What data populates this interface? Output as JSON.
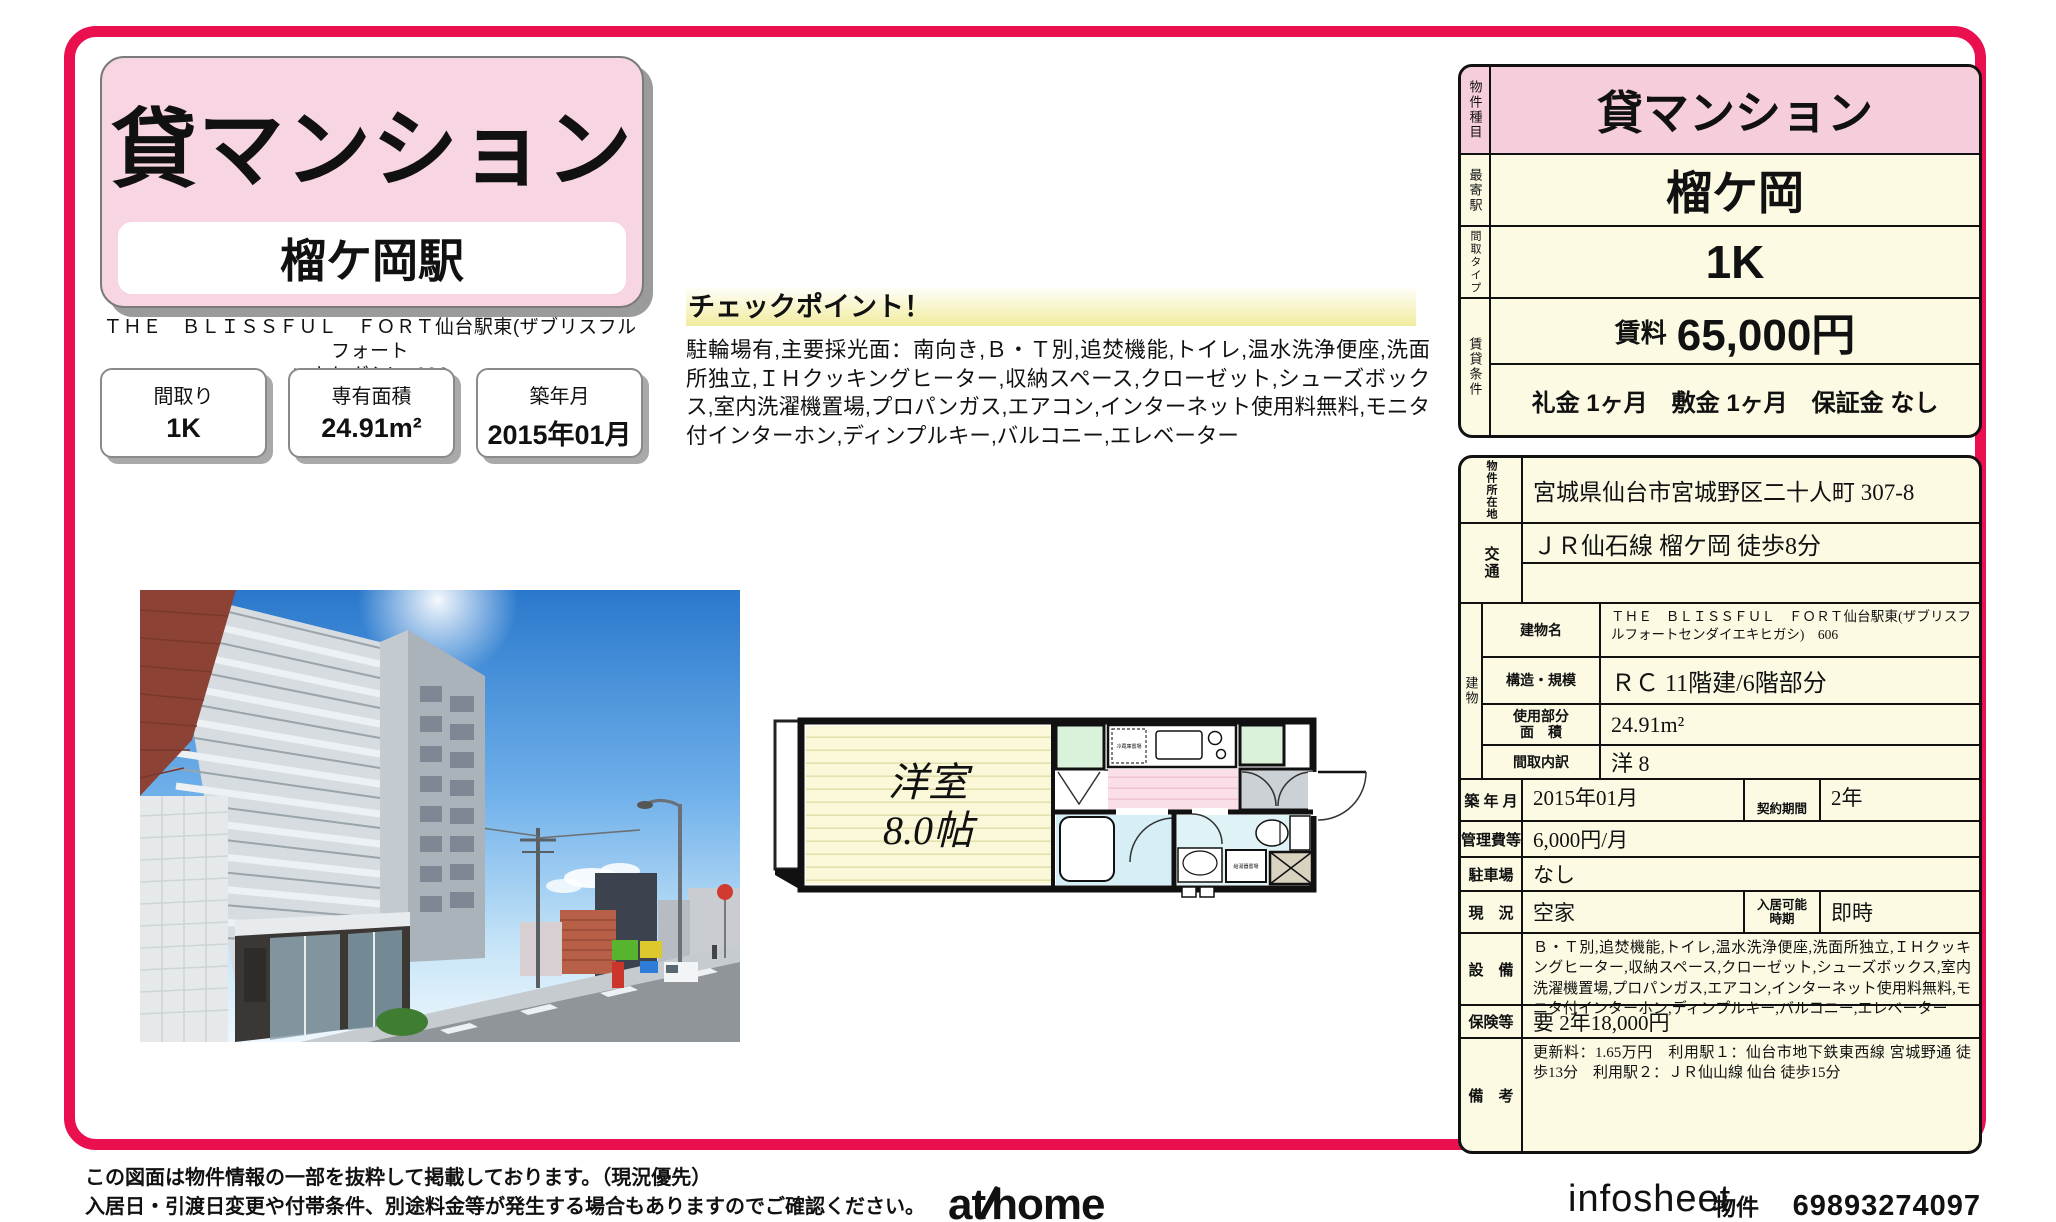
{
  "colors": {
    "accent_red": "#ea0f4e",
    "card_pink": "#f8d5e2",
    "table_pink": "#f6cddb",
    "table_cream": "#fcfae3",
    "highlight_yellow": "#f0ec9e"
  },
  "header": {
    "property_type": "貸マンション",
    "station": "榴ケ岡駅",
    "building_name_line1": "ＴＨＥ　ＢＬＩＳＳＦＵＬ　ＦＯＲＴ仙台駅東(ザブリスフルフォート",
    "building_name_line2": "エキヒガシ)　606"
  },
  "spec_boxes": [
    {
      "label": "間取り",
      "value": "1K"
    },
    {
      "label": "専有面積",
      "value": "24.91m²"
    },
    {
      "label": "築年月",
      "value": "2015年01月"
    }
  ],
  "checkpoint": {
    "title": "チェックポイント！",
    "body": "駐輪場有,主要採光面：南向き,Ｂ・Ｔ別,追焚機能,トイレ,温水洗浄便座,洗面所独立,ＩＨクッキングヒーター,収納スペース,クローゼット,シューズボックス,室内洗濯機置場,プロパンガス,エアコン,インターネット使用料無料,モニタ付インターホン,ディンプルキー,バルコニー,エレベーター"
  },
  "floorplan": {
    "room_line1": "洋室",
    "room_line2": "8.0帖",
    "fridge_label": "冷蔵庫置場",
    "utility_label": "給湯器置場"
  },
  "summary_table": {
    "type_label": "物件種目",
    "type": "貸マンション",
    "station_label": "最寄駅",
    "station": "榴ケ岡",
    "layout_label": "間取タイプ",
    "layout": "1K",
    "terms_label": "賃貸条件",
    "rent_label": "賃料",
    "rent": "65,000円",
    "terms": "礼金 1ヶ月　敷金 1ヶ月　保証金 なし"
  },
  "detail_table": {
    "location_label": "物件所在地",
    "location": "宮城県仙台市宮城野区二十人町 307-8",
    "access_label": "交通",
    "access1": "ＪＲ仙石線 榴ケ岡 徒歩8分",
    "access2": "",
    "building_group_label": "建物",
    "building_name_label": "建物名",
    "building_name": "ＴＨＥ　ＢＬＩＳＳＦＵＬ　ＦＯＲＴ仙台駅東(ザブリスフルフォートセンダイエキヒガシ)　606",
    "structure_label": "構造・規模",
    "structure": "ＲＣ 11階建/6階部分",
    "area_label1": "使用部分",
    "area_label2": "面　積",
    "area": "24.91m²",
    "layout_label": "間取内訳",
    "layout": "洋 8",
    "built_label": "築 年 月",
    "built": "2015年01月",
    "contract_label": "契約期間",
    "contract": "2年",
    "fee_label": "管理費等",
    "fee": "6,000円/月",
    "parking_label": "駐車場",
    "parking": "なし",
    "status_label": "現　況",
    "status": "空家",
    "movein_label1": "入居可能",
    "movein_label2": "時期",
    "movein": "即時",
    "equipment_label": "設　備",
    "equipment": "Ｂ・Ｔ別,追焚機能,トイレ,温水洗浄便座,洗面所独立,ＩＨクッキングヒーター,収納スペース,クローゼット,シューズボックス,室内洗濯機置場,プロパンガス,エアコン,インターネット使用料無料,モニタ付インターホン,ディンプルキー,バルコニー,エレベーター",
    "insurance_label": "保険等",
    "insurance": "要 2年18,000円",
    "notes_label": "備　考",
    "notes": "更新料：1.65万円　利用駅１：仙台市地下鉄東西線 宮城野通 徒歩13分　利用駅２：ＪＲ仙山線 仙台 徒歩15分"
  },
  "footer": {
    "note_line1": "この図面は物件情報の一部を抜粋して掲載しております。（現況優先）",
    "note_line2": "入居日・引渡日変更や付帯条件、別途料金等が発生する場合もありますのでご確認ください。",
    "logo_at": "at",
    "logo_home": "home",
    "infosheet": "infosheet",
    "property_no_label": "物件番号",
    "property_no": "69893274097"
  }
}
